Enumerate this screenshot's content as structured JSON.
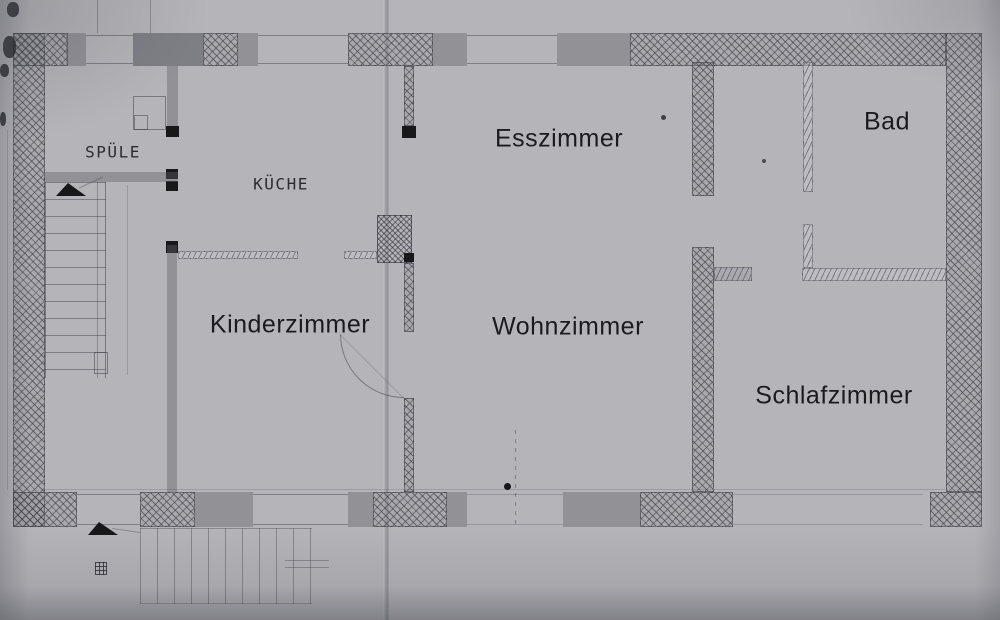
{
  "document": {
    "title": "Grundriss (scanned floor plan)",
    "colors": {
      "paper": "#b5b5b9",
      "ink": "#3c3c42",
      "wash": "#60606a",
      "label": "#1b1b1e"
    }
  },
  "rooms": [
    {
      "id": "spuele",
      "label": "SPÜLE",
      "lettering": "hand-drawn"
    },
    {
      "id": "kueche",
      "label": "KÜCHE",
      "lettering": "hand-drawn"
    },
    {
      "id": "esszimmer",
      "label": "Esszimmer",
      "lettering": "digital"
    },
    {
      "id": "bad",
      "label": "Bad",
      "lettering": "digital"
    },
    {
      "id": "kinderzimmer",
      "label": "Kinderzimmer",
      "lettering": "digital"
    },
    {
      "id": "wohnzimmer",
      "label": "Wohnzimmer",
      "lettering": "digital"
    },
    {
      "id": "schlafzimmer",
      "label": "Schlafzimmer",
      "lettering": "digital"
    }
  ],
  "symbols": {
    "masonry-wall": "cross-hatched band",
    "partition-wall": "thin band with diagonal ticks",
    "window": "gray wash block inside wall",
    "door-post": "small black square",
    "door-swing": "black triangle / quarter arc",
    "interior-stairs": "tread ladder, upper left",
    "exterior-stairs": "vertical tread lines, lower left",
    "chimney": "dense hatched block between rooms",
    "paper-fold": "vertical crease at one-third width"
  }
}
